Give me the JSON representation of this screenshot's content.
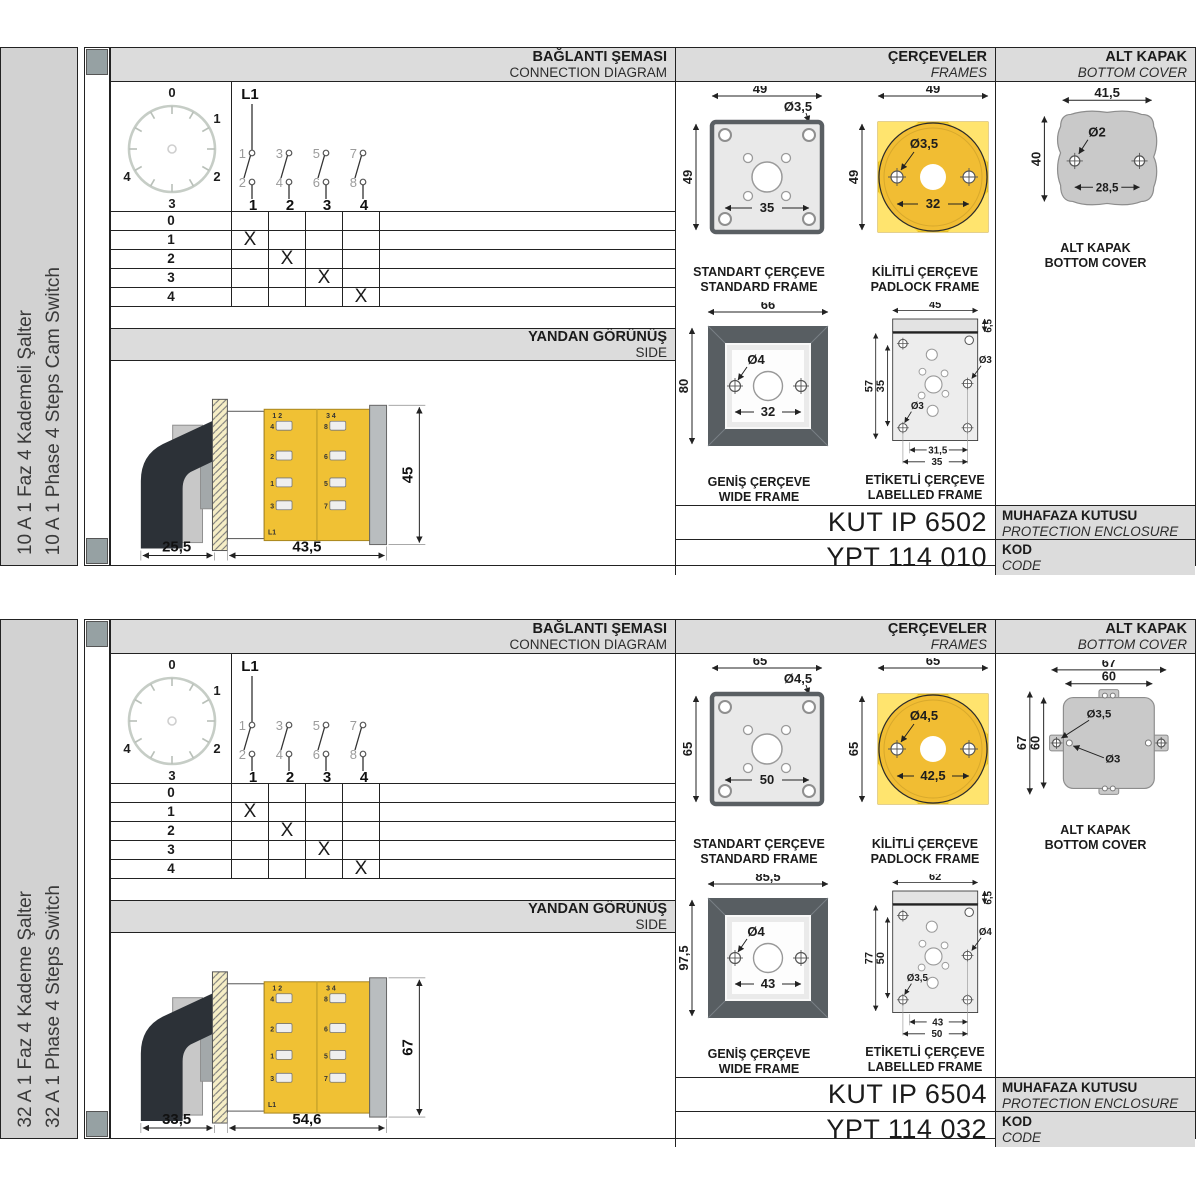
{
  "sections": [
    {
      "sidebar": {
        "tr": "10 A 1 Faz 4 Kademeli Şalter",
        "en": "10 A 1 Phase 4 Steps Cam Switch"
      },
      "headers": {
        "connection_tr": "BAĞLANTI ŞEMASI",
        "connection_en": "CONNECTION DIAGRAM",
        "frames_tr": "ÇERÇEVELER",
        "frames_en": "FRAMES",
        "cover_tr": "ALT KAPAK",
        "cover_en": "BOTTOM COVER",
        "side_tr": "YANDAN GÖRÜNÜŞ",
        "side_en": "SIDE"
      },
      "dial": {
        "labels": [
          "0",
          "1",
          "2",
          "3",
          "4"
        ]
      },
      "circuit": {
        "source": "L1",
        "top": [
          "1",
          "3",
          "5",
          "7"
        ],
        "bottom": [
          "2",
          "4",
          "6",
          "8"
        ],
        "poles": [
          "1",
          "2",
          "3",
          "4"
        ]
      },
      "table": {
        "steps": [
          "0",
          "1",
          "2",
          "3",
          "4"
        ],
        "marks": [
          [
            "",
            "",
            "",
            ""
          ],
          [
            "X",
            "",
            "",
            ""
          ],
          [
            "",
            "X",
            "",
            ""
          ],
          [
            "",
            "",
            "X",
            ""
          ],
          [
            "",
            "",
            "",
            "X"
          ]
        ]
      },
      "side_view": {
        "dim_front": "25,5",
        "dim_body": "43,5",
        "dim_height": "45",
        "pair_left": "1 2",
        "pair_right": "3 4",
        "source": "L1",
        "terms_left": [
          "4",
          "2",
          "1",
          "3"
        ],
        "terms_right": [
          "8",
          "6",
          "5",
          "7"
        ]
      },
      "frames": {
        "standard": {
          "tr": "STANDART ÇERÇEVE",
          "en": "STANDARD FRAME",
          "w": "49",
          "h": "49",
          "c": "35",
          "dia": "Ø3,5"
        },
        "padlock": {
          "tr": "KİLİTLİ ÇERÇEVE",
          "en": "PADLOCK FRAME",
          "w": "49",
          "h": "49",
          "c": "32",
          "dia": "Ø3,5"
        },
        "wide": {
          "tr": "GENİŞ ÇERÇEVE",
          "en": "WIDE FRAME",
          "w": "66",
          "h": "80",
          "c": "32",
          "dia": "Ø4"
        },
        "labelled": {
          "tr": "ETİKETLİ ÇERÇEVE",
          "en": "LABELLED FRAME",
          "w": "45",
          "h": "57",
          "band": "6,5",
          "inner": "35",
          "b1": "31,5",
          "b2": "35",
          "dia1": "Ø3",
          "dia2": "Ø3"
        }
      },
      "cover": {
        "tr": "ALT KAPAK",
        "en": "BOTTOM COVER",
        "w": "41,5",
        "h": "40",
        "c": "28,5",
        "dia": "Ø2"
      },
      "enclosure": {
        "code": "KUT IP 6502",
        "tr": "MUHAFAZA KUTUSU",
        "en": "PROTECTION ENCLOSURE"
      },
      "code": {
        "value": "YPT 114 010",
        "tr": "KOD",
        "en": "CODE"
      }
    },
    {
      "sidebar": {
        "tr": "32 A 1 Faz 4 Kademe Şalter",
        "en": "32 A 1 Phase 4 Steps Switch"
      },
      "headers": {
        "connection_tr": "BAĞLANTI ŞEMASI",
        "connection_en": "CONNECTION DIAGRAM",
        "frames_tr": "ÇERÇEVELER",
        "frames_en": "FRAMES",
        "cover_tr": "ALT KAPAK",
        "cover_en": "BOTTOM COVER",
        "side_tr": "YANDAN GÖRÜNÜŞ",
        "side_en": "SIDE"
      },
      "dial": {
        "labels": [
          "0",
          "1",
          "2",
          "3",
          "4"
        ]
      },
      "circuit": {
        "source": "L1",
        "top": [
          "1",
          "3",
          "5",
          "7"
        ],
        "bottom": [
          "2",
          "4",
          "6",
          "8"
        ],
        "poles": [
          "1",
          "2",
          "3",
          "4"
        ]
      },
      "table": {
        "steps": [
          "0",
          "1",
          "2",
          "3",
          "4"
        ],
        "marks": [
          [
            "",
            "",
            "",
            ""
          ],
          [
            "X",
            "",
            "",
            ""
          ],
          [
            "",
            "X",
            "",
            ""
          ],
          [
            "",
            "",
            "X",
            ""
          ],
          [
            "",
            "",
            "",
            "X"
          ]
        ]
      },
      "side_view": {
        "dim_front": "33,5",
        "dim_body": "54,6",
        "dim_height": "67",
        "pair_left": "1 2",
        "pair_right": "3 4",
        "source": "L1",
        "terms_left": [
          "4",
          "2",
          "1",
          "3"
        ],
        "terms_right": [
          "8",
          "6",
          "5",
          "7"
        ]
      },
      "frames": {
        "standard": {
          "tr": "STANDART ÇERÇEVE",
          "en": "STANDARD FRAME",
          "w": "65",
          "h": "65",
          "c": "50",
          "dia": "Ø4,5"
        },
        "padlock": {
          "tr": "KİLİTLİ ÇERÇEVE",
          "en": "PADLOCK FRAME",
          "w": "65",
          "h": "65",
          "c": "42,5",
          "dia": "Ø4,5"
        },
        "wide": {
          "tr": "GENİŞ ÇERÇEVE",
          "en": "WIDE FRAME",
          "w": "85,5",
          "h": "97,5",
          "c": "43",
          "dia": "Ø4"
        },
        "labelled": {
          "tr": "ETİKETLİ ÇERÇEVE",
          "en": "LABELLED FRAME",
          "w": "62",
          "h": "77",
          "band": "6,5",
          "inner": "50",
          "b1": "43",
          "b2": "50",
          "dia1": "Ø4",
          "dia2": "Ø3,5"
        }
      },
      "cover": {
        "tr": "ALT KAPAK",
        "en": "BOTTOM COVER",
        "w_outer": "67",
        "w_inner": "60",
        "h_outer": "67",
        "h_inner": "60",
        "dia1": "Ø3,5",
        "dia2": "Ø3"
      },
      "enclosure": {
        "code": "KUT IP 6504",
        "tr": "MUHAFAZA KUTUSU",
        "en": "PROTECTION ENCLOSURE"
      },
      "code": {
        "value": "YPT 114 032",
        "tr": "KOD",
        "en": "CODE"
      }
    }
  ]
}
